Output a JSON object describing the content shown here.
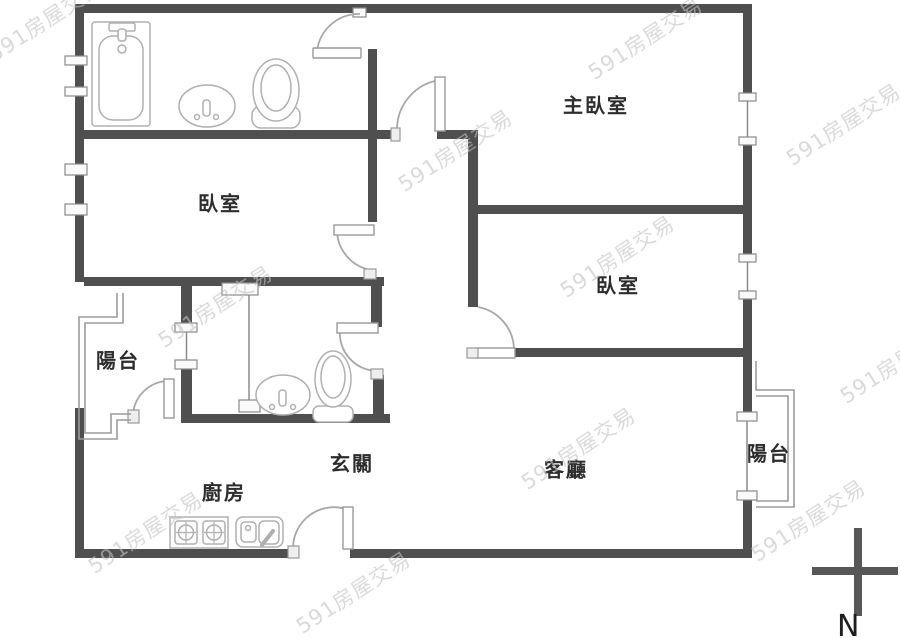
{
  "page": {
    "description": "apartment floor plan",
    "background_color": "#ffffff"
  },
  "colors": {
    "wall": "#4f4f4f",
    "door_swing": "#a8a8a8",
    "fixture_outline": "#b0b0b0",
    "railing": "#9c9c9c",
    "room_label": "#2d2d2d",
    "watermark": "#c3c3c3"
  },
  "rooms": [
    {
      "id": "master-bedroom",
      "label": "主臥室",
      "x": 596,
      "y": 104
    },
    {
      "id": "bedroom-1",
      "label": "臥室",
      "x": 220,
      "y": 202
    },
    {
      "id": "bedroom-2",
      "label": "臥室",
      "x": 618,
      "y": 284
    },
    {
      "id": "balcony-left",
      "label": "陽台",
      "x": 118,
      "y": 359
    },
    {
      "id": "balcony-right",
      "label": "陽台",
      "x": 769,
      "y": 452
    },
    {
      "id": "entry-hall",
      "label": "玄關",
      "x": 352,
      "y": 462
    },
    {
      "id": "kitchen",
      "label": "廚房",
      "x": 224,
      "y": 491
    },
    {
      "id": "living-room",
      "label": "客廳",
      "x": 566,
      "y": 468
    }
  ],
  "fixtures": [
    "bathtub-icon",
    "washbasin-icon",
    "toilet-icon",
    "washbasin-icon",
    "toilet-icon",
    "stove-icon",
    "kitchen-sink-icon",
    "north-compass-icon"
  ],
  "compass": {
    "north_label": "N"
  },
  "watermark": {
    "text": "591房屋交易",
    "positions": [
      {
        "x": 45,
        "y": 20
      },
      {
        "x": 645,
        "y": 38
      },
      {
        "x": 455,
        "y": 150
      },
      {
        "x": 843,
        "y": 124
      },
      {
        "x": 215,
        "y": 306
      },
      {
        "x": 617,
        "y": 256
      },
      {
        "x": 145,
        "y": 532
      },
      {
        "x": 578,
        "y": 448
      },
      {
        "x": 353,
        "y": 592
      },
      {
        "x": 808,
        "y": 520
      },
      {
        "x": 897,
        "y": 362
      }
    ]
  }
}
